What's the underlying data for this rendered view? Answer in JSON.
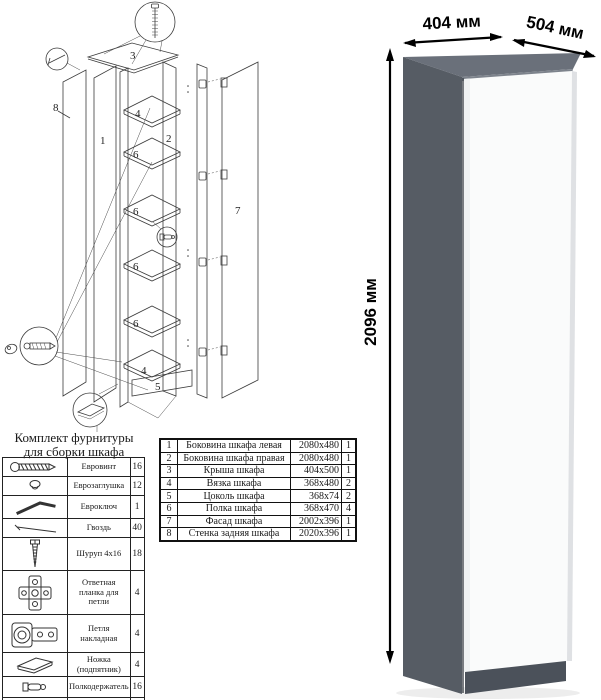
{
  "hardware": {
    "title_line1": "Комплект фурнитуры",
    "title_line2": "для сборки шкафа",
    "rows": [
      {
        "icon": "confirmat-screw-icon",
        "name": "Евровинт",
        "qty": "16"
      },
      {
        "icon": "euro-cap-icon",
        "name": "Еврозаглушка",
        "qty": "12"
      },
      {
        "icon": "hex-key-icon",
        "name": "Евроключ",
        "qty": "1"
      },
      {
        "icon": "nail-icon",
        "name": "Гвоздь",
        "qty": "40"
      },
      {
        "icon": "screw-icon",
        "name": "Шуруп 4x16",
        "qty": "18"
      },
      {
        "icon": "hinge-plate-icon",
        "name": "Ответная планка для петли",
        "qty": "4"
      },
      {
        "icon": "hinge-icon",
        "name": "Петля накладная",
        "qty": "4"
      },
      {
        "icon": "foot-icon",
        "name": "Ножка (подпятник)",
        "qty": "4"
      },
      {
        "icon": "shelf-pin-icon",
        "name": "Полкодержатель",
        "qty": "16"
      },
      {
        "icon": "push-rod-icon",
        "name": "Толкатель (пуш)",
        "qty": "1"
      }
    ]
  },
  "parts_table": {
    "rows": [
      {
        "num": "1",
        "name": "Боковина шкафа левая",
        "size": "2080x480",
        "qty": "1"
      },
      {
        "num": "2",
        "name": "Боковина шкафа правая",
        "size": "2080x480",
        "qty": "1"
      },
      {
        "num": "3",
        "name": "Крыша шкафа",
        "size": "404x500",
        "qty": "1"
      },
      {
        "num": "4",
        "name": "Вязка шкафа",
        "size": "368x480",
        "qty": "2"
      },
      {
        "num": "5",
        "name": "Цоколь шкафа",
        "size": "368x74",
        "qty": "2"
      },
      {
        "num": "6",
        "name": "Полка шкафа",
        "size": "368x470",
        "qty": "4"
      },
      {
        "num": "7",
        "name": "Фасад шкафа",
        "size": "2002x396",
        "qty": "1"
      },
      {
        "num": "8",
        "name": "Стенка задняя шкафа",
        "size": "2020x396",
        "qty": "1"
      }
    ]
  },
  "diagram": {
    "labels": {
      "n1": "1",
      "n2": "2",
      "n3": "3",
      "n4a": "4",
      "n4b": "4",
      "n5": "5",
      "n6a": "6",
      "n6b": "6",
      "n6c": "6",
      "n6d": "6",
      "n7": "7",
      "n8": "8"
    }
  },
  "render": {
    "width_label": "404 мм",
    "depth_label": "504 мм",
    "height_label": "2096 мм",
    "colors": {
      "side": "#565c64",
      "top": "#6a707a",
      "top_edge": "#7d838c",
      "plinth": "#4b515a",
      "door": "#fafbfb",
      "door_shade": "#eff1f2",
      "right_edge": "#dfe1e4"
    }
  }
}
